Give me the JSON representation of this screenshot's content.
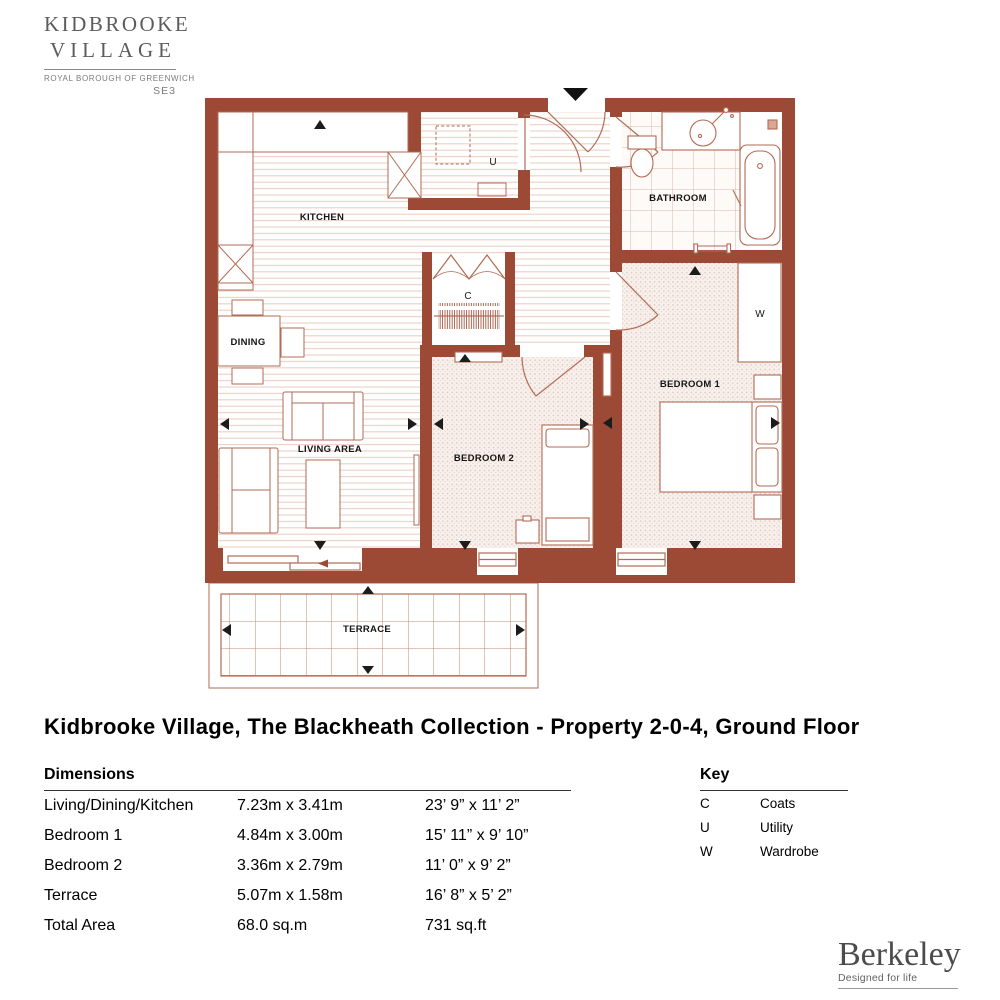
{
  "logo": {
    "line1": "KIDBROOKE",
    "line2": "VILLAGE",
    "subtitle": "ROYAL BOROUGH OF GREENWICH",
    "postcode": "SE3"
  },
  "title": "Kidbrooke Village, The Blackheath Collection - Property 2-0-4, Ground Floor",
  "floorplan": {
    "labels": {
      "kitchen": "KITCHEN",
      "dining": "DINING",
      "living": "LIVING AREA",
      "bedroom1": "BEDROOM 1",
      "bedroom2": "BEDROOM 2",
      "bathroom": "BATHROOM",
      "terrace": "TERRACE",
      "utility": "U",
      "coats": "C",
      "wardrobe": "W"
    },
    "colors": {
      "wall": "#9c4a36",
      "furniture_line": "#b26b54",
      "wood_line": "#ecd0c4",
      "tile_line": "#dcbbac",
      "carpet_dot": "#ddc3b8",
      "arrow": "#1c1c1c"
    }
  },
  "dimensions": {
    "heading": "Dimensions",
    "rows": [
      {
        "name": "Living/Dining/Kitchen",
        "metric": "7.23m x 3.41m",
        "imperial": "23’ 9” x 11’ 2”"
      },
      {
        "name": "Bedroom 1",
        "metric": "4.84m x 3.00m",
        "imperial": "15’ 11” x 9’ 10”"
      },
      {
        "name": "Bedroom 2",
        "metric": "3.36m x 2.79m",
        "imperial": "11’ 0” x 9’ 2”"
      },
      {
        "name": "Terrace",
        "metric": "5.07m x 1.58m",
        "imperial": "16’ 8” x 5’ 2”"
      },
      {
        "name": "Total Area",
        "metric": "68.0 sq.m",
        "imperial": "731 sq.ft"
      }
    ]
  },
  "key": {
    "heading": "Key",
    "items": [
      {
        "code": "C",
        "label": "Coats"
      },
      {
        "code": "U",
        "label": "Utility"
      },
      {
        "code": "W",
        "label": "Wardrobe"
      }
    ]
  },
  "brand": {
    "name": "Berkeley",
    "tagline": "Designed for life"
  }
}
